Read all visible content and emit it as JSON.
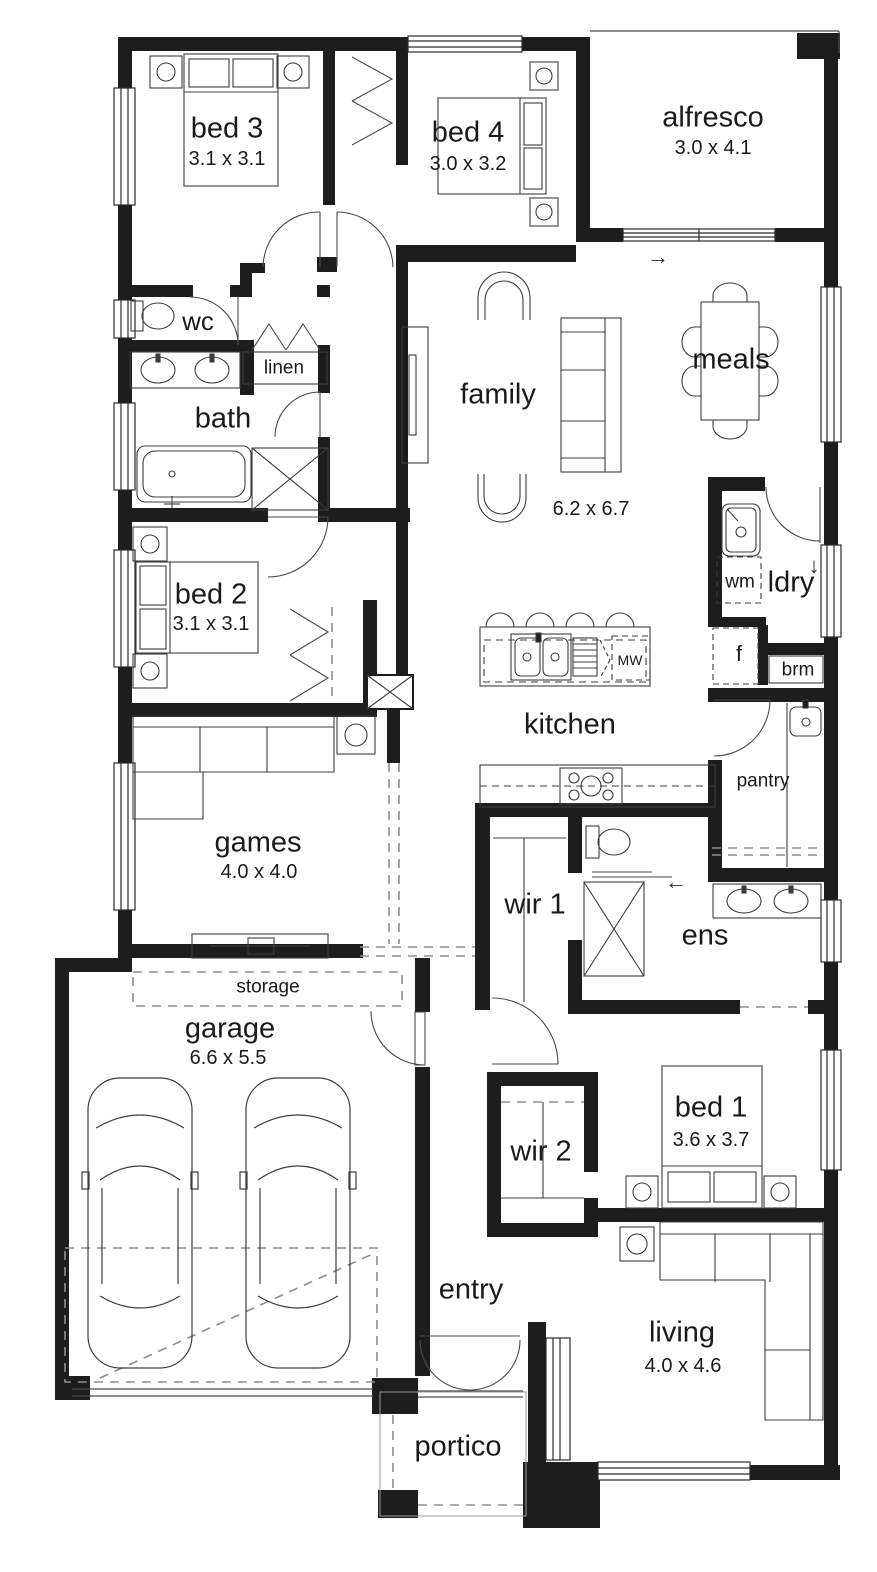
{
  "plan": {
    "rooms": {
      "bed3": {
        "label": "bed 3",
        "size": "3.1 x 3.1"
      },
      "bed4": {
        "label": "bed 4",
        "size": "3.0 x 3.2"
      },
      "alfresco": {
        "label": "alfresco",
        "size": "3.0 x 4.1"
      },
      "wc": {
        "label": "wc"
      },
      "linen": {
        "label": "linen"
      },
      "bath": {
        "label": "bath"
      },
      "family": {
        "label": "family",
        "size": "6.2 x 6.7"
      },
      "meals": {
        "label": "meals"
      },
      "ldry": {
        "label": "ldry"
      },
      "wm": {
        "label": "wm"
      },
      "fridge": {
        "label": "f"
      },
      "brm": {
        "label": "brm"
      },
      "kitchen": {
        "label": "kitchen"
      },
      "mw": {
        "label": "MW"
      },
      "pantry": {
        "label": "pantry"
      },
      "bed2": {
        "label": "bed 2",
        "size": "3.1 x 3.1"
      },
      "games": {
        "label": "games",
        "size": "4.0 x 4.0"
      },
      "wir1": {
        "label": "wir 1"
      },
      "ens": {
        "label": "ens"
      },
      "storage": {
        "label": "storage"
      },
      "garage": {
        "label": "garage",
        "size": "6.6 x 5.5"
      },
      "wir2": {
        "label": "wir 2"
      },
      "bed1": {
        "label": "bed 1",
        "size": "3.6 x 3.7"
      },
      "entry": {
        "label": "entry"
      },
      "living": {
        "label": "living",
        "size": "4.0 x 4.6"
      },
      "portico": {
        "label": "portico"
      }
    },
    "symbols": {
      "arrow_right": "→",
      "arrow_down": "↓",
      "arrow_left": "←"
    },
    "colors": {
      "wall": "#1d1d1d",
      "line": "#3c3c3c",
      "dash": "#8f8f8f",
      "bg": "#ffffff"
    }
  }
}
